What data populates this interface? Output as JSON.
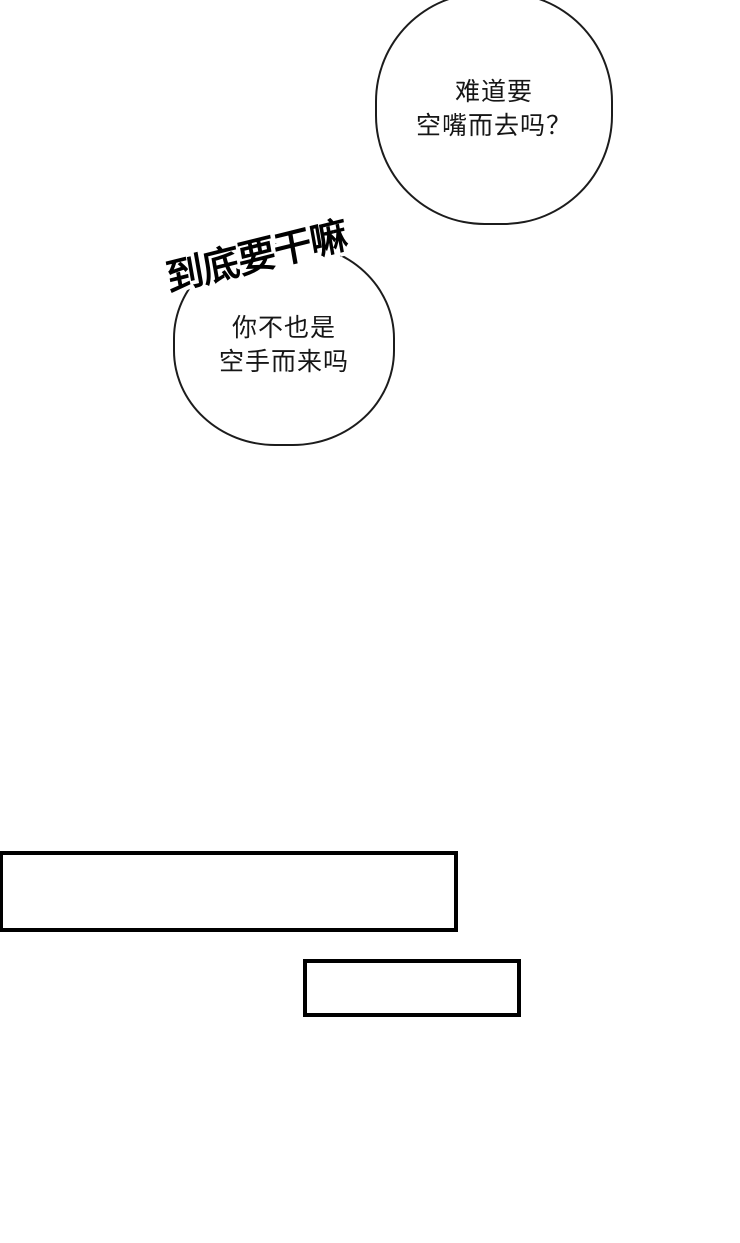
{
  "page": {
    "background_color": "#ffffff",
    "line_color": "#1c1c1c"
  },
  "bubbles": [
    {
      "position": "top-right",
      "lines": [
        "难道要",
        "空嘴而去吗？"
      ]
    },
    {
      "position": "middle-left",
      "lines": [
        "你不也是",
        "空手而来吗"
      ]
    }
  ],
  "sfx": {
    "text": "到底要干嘛"
  }
}
